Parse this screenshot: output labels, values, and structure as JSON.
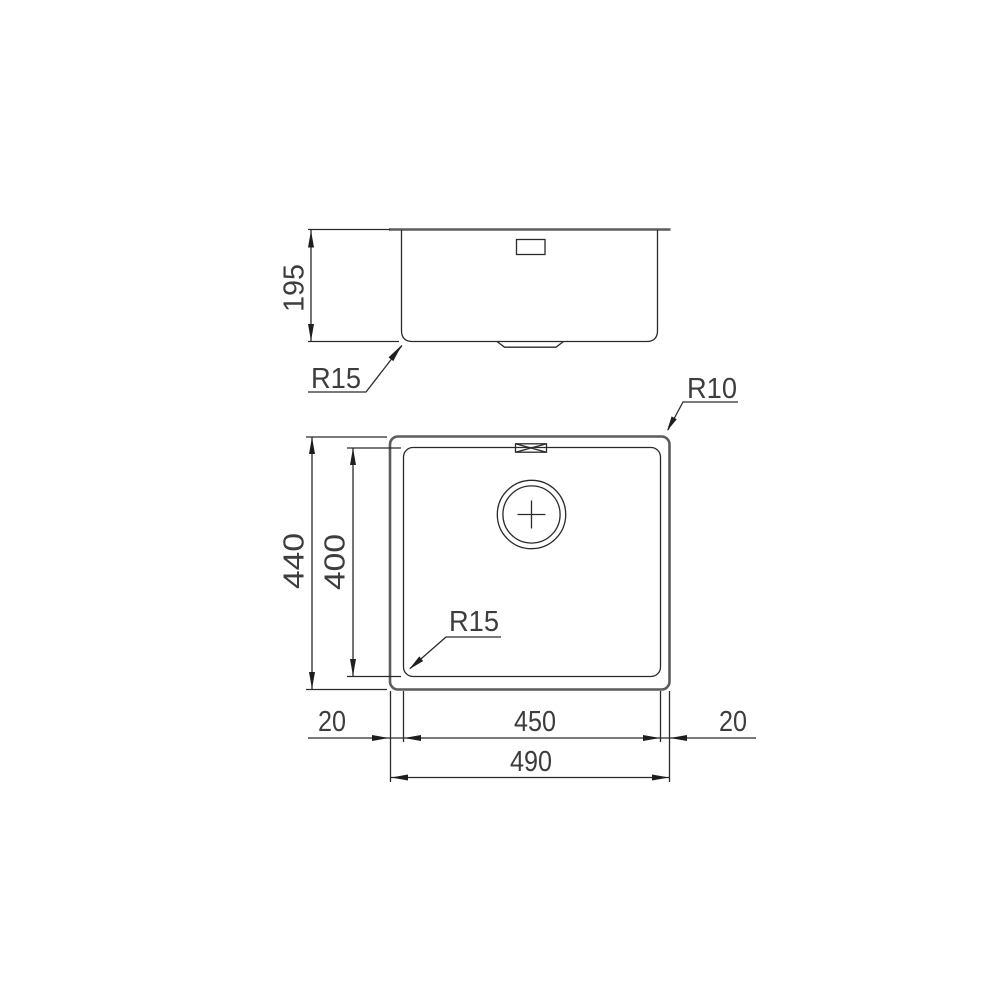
{
  "side_view": {
    "depth_mm": "195",
    "bottom_corner_radius": "R15"
  },
  "plan_view": {
    "outer_height_mm": "440",
    "bowl_height_mm": "400",
    "top_corner_radius": "R10",
    "bowl_corner_radius": "R15",
    "bowl_width_mm": "450",
    "outer_width_mm": "490",
    "left_rim_mm": "20",
    "right_rim_mm": "20"
  },
  "colors": {
    "background": "#ffffff",
    "thin_line": "#2a2a2a",
    "outline": "#5c5c5c",
    "text": "#3d3d3d"
  }
}
